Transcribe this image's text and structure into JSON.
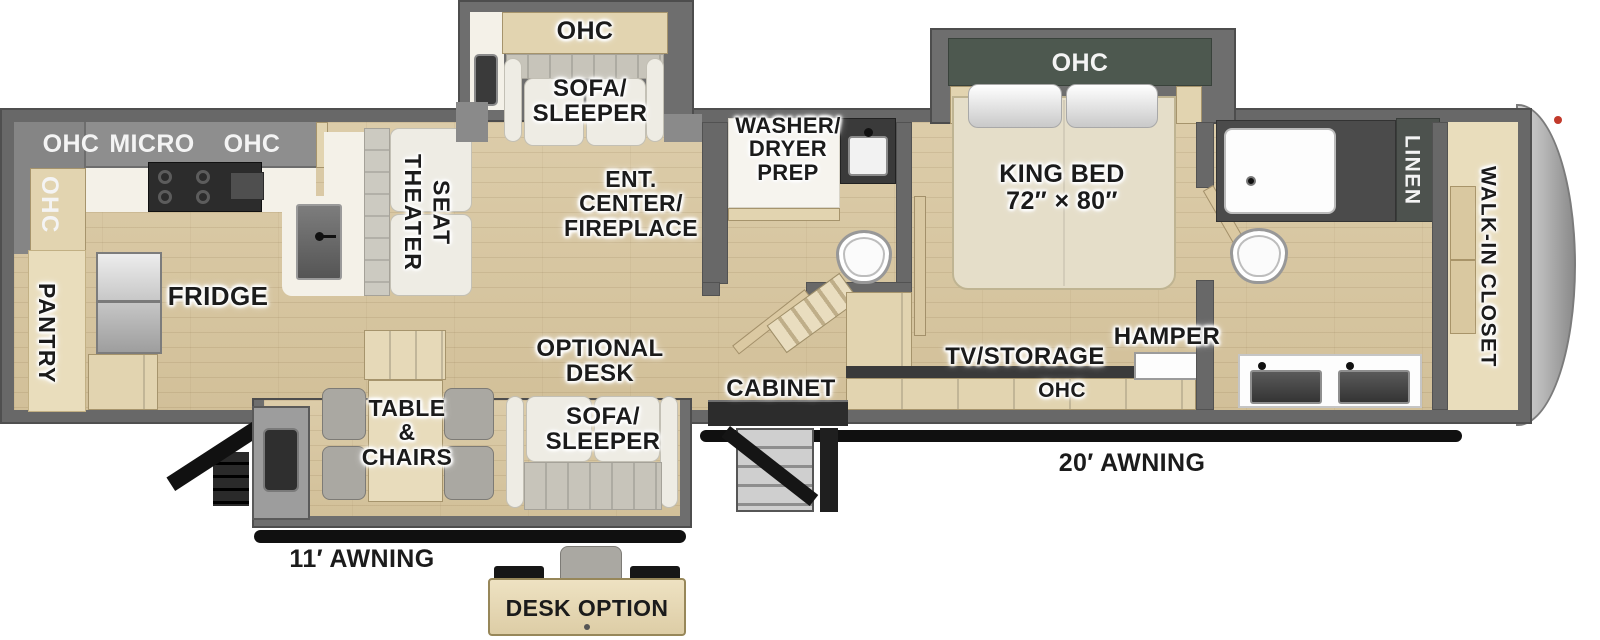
{
  "colors": {
    "wall_gray": "#686868",
    "floor_wood": "#d8c7a4",
    "cabinet_wood": "#e2d4b0",
    "closet_tan": "#e9ddbc",
    "ohc_band_gray": "#8e8e8e",
    "bedroom_ohc_green": "#4d584f",
    "counter_dark": "#2c2c2c",
    "sofa_light": "#eeece4",
    "awning_black": "#101010",
    "front_cap_gray": "#bfbfbf",
    "marker_red": "#c23a2b"
  },
  "rear_kitchen": {
    "ohc_side": "OHC",
    "ohc_top": "OHC",
    "micro": "MICRO",
    "ohc_top_2": "OHC",
    "pantry": "PANTRY",
    "fridge": "FRIDGE"
  },
  "living_area": {
    "theater_seat": "THEATER\nSEAT",
    "ent_center": "ENT.\nCENTER/\nFIREPLACE",
    "optional_desk": "OPTIONAL\nDESK",
    "table_chairs": "TABLE\n&\nCHAIRS",
    "cabinet": "CABINET"
  },
  "sofa_slide": {
    "ohc": "OHC",
    "sofa_sleeper": "SOFA/\nSLEEPER"
  },
  "lower_slide": {
    "sofa_sleeper": "SOFA/\nSLEEPER"
  },
  "mid_bath": {
    "washer_dryer_prep": "WASHER/\nDRYER\nPREP"
  },
  "bedroom": {
    "king_bed": "KING BED\n72″ × 80″",
    "ohc": "OHC",
    "tv_storage": "TV/STORAGE",
    "hamper": "HAMPER",
    "console_ohc": "OHC"
  },
  "front_bath": {
    "linen": "LINEN"
  },
  "front_closet": {
    "walk_in_closet": "WALK-IN CLOSET"
  },
  "exterior": {
    "awning_rear": "11′ AWNING",
    "awning_main": "20′ AWNING"
  },
  "inset": {
    "desk_option": "DESK OPTION"
  }
}
